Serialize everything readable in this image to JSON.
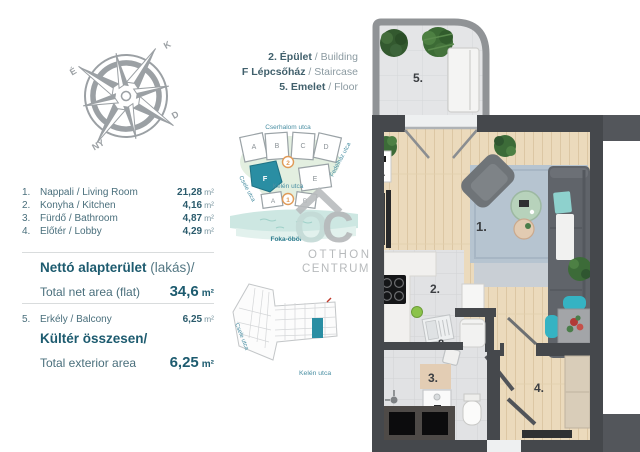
{
  "unit_info": {
    "line1": {
      "hu": "2. Épület",
      "en": " / Building"
    },
    "line2": {
      "hu": "F Lépcsőház",
      "en": " / Staircase"
    },
    "line3": {
      "hu": "5. Emelet",
      "en": " / Floor"
    }
  },
  "left_panel": {
    "rooms": [
      {
        "num": "1.",
        "name": "Nappali / Living Room",
        "area": "21,28",
        "unit": "m²"
      },
      {
        "num": "2.",
        "name": "Konyha / Kitchen",
        "area": "4,16",
        "unit": "m²"
      },
      {
        "num": "3.",
        "name": "Fürdő / Bathroom",
        "area": "4,87",
        "unit": "m²"
      },
      {
        "num": "4.",
        "name": "Előtér / Lobby",
        "area": "4,29",
        "unit": "m²"
      }
    ],
    "net_title_bold": "Nettó alapterület",
    "net_title_rest": " (lakás)/",
    "net_label": "Total net area (flat)",
    "net_value": "34,6",
    "net_unit": "m²",
    "balcony_row": {
      "num": "5.",
      "name": "Erkély / Balcony",
      "area": "6,25",
      "unit": "m²"
    },
    "ext_title": "Kültér összesen/",
    "ext_label": "Total exterior area",
    "ext_value": "6,25",
    "ext_unit": "m²"
  },
  "compass": {
    "n": "É",
    "e": "K",
    "s": "D",
    "w": "NY"
  },
  "site_map": {
    "street_top": "Cserhalom utca",
    "street_left": "Csele utca",
    "street_right": "Fedélház utca",
    "street_mid": "Kelén utca",
    "bay": "Foka-öböl",
    "top_buildings": [
      "A",
      "B",
      "C",
      "D"
    ],
    "mid_highlighted": "F",
    "mid_other": "E",
    "bottom_buildings": [
      "A",
      "B"
    ],
    "marker_upper": "2",
    "marker_lower": "1",
    "highlight_color": "#2a8ea3",
    "marker_color": "#e09a57"
  },
  "floor_map": {
    "street_left": "Csele utca",
    "street_bottom": "Kelén utca",
    "highlight_color": "#2a8ea3"
  },
  "watermark": {
    "line1": "OTTHON",
    "line2": "CENTRUM"
  },
  "plan": {
    "room_labels": {
      "living": "1.",
      "kitchen": "2.",
      "bathroom": "3.",
      "lobby": "4.",
      "balcony": "5.",
      "utility": "8."
    },
    "section_marker": "A",
    "wall_color": "#45484c",
    "wood_color": "#ebdabc",
    "accent_teal": "#35b3c3"
  }
}
